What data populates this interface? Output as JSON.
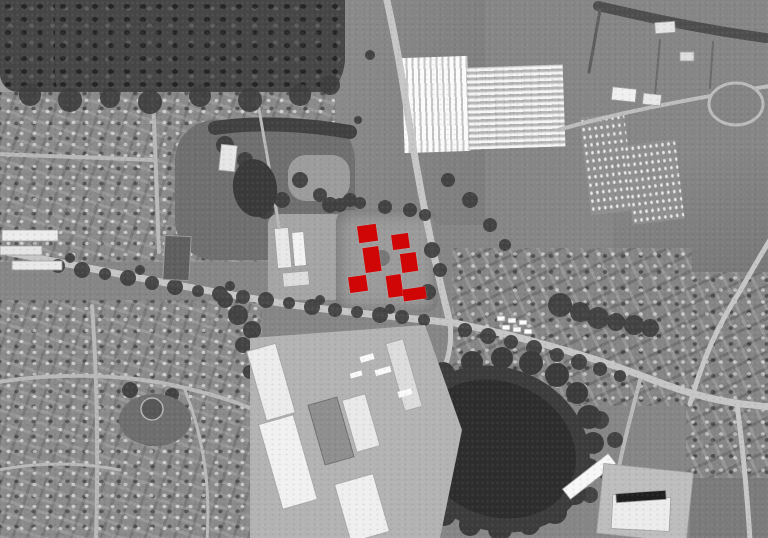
{
  "meta": {
    "title": "Grayscale aerial orthophoto with red-highlighted site buildings",
    "image_type": "annotated satellite / aerial photograph",
    "canvas": {
      "width": 768,
      "height": 538
    }
  },
  "palette": {
    "base_gray": "#868686",
    "forest_dark": "#464646",
    "water_dark": "#2d2d2d",
    "road_light": "#c6c6c6",
    "building_white": "#efefef",
    "highlight_red": "#d00505"
  },
  "annotations": {
    "site_buildings": {
      "color": "#d00505",
      "rotation_deg": -8,
      "markers": [
        {
          "id": "highlighted-building-1",
          "cx": 367,
          "cy": 233,
          "w": 19,
          "h": 17
        },
        {
          "id": "highlighted-building-2",
          "cx": 400,
          "cy": 241,
          "w": 17,
          "h": 15
        },
        {
          "id": "highlighted-building-3",
          "cx": 371.5,
          "cy": 259.5,
          "w": 15.5,
          "h": 25
        },
        {
          "id": "highlighted-building-4",
          "cx": 408.5,
          "cy": 262,
          "w": 15.5,
          "h": 18.5
        },
        {
          "id": "highlighted-building-5",
          "cx": 358,
          "cy": 284,
          "w": 18,
          "h": 15.5
        },
        {
          "id": "highlighted-building-6",
          "cx": 394,
          "cy": 286,
          "w": 15,
          "h": 21.5
        },
        {
          "id": "highlighted-building-7",
          "cx": 414.5,
          "cy": 294,
          "w": 22.5,
          "h": 11.5
        }
      ]
    }
  },
  "regions": {
    "forest_top_left": "Dense woodland (north-west)",
    "field_left_edge": "Small field at left edge",
    "residential_nw": "Residential area north of main road",
    "residential_sw": "Residential area south-west",
    "residential_se": "Housing along road (south-east)",
    "residential_e": "Housing along east edge",
    "park_center": "Park with pond and trees",
    "clearing_center": "Grass clearing",
    "nursery_pad": "Nursery compound",
    "site_pad": "Development site (highlighted buildings)",
    "fields_top_center": "Open fields (north)",
    "greenhouse_west": "Glasshouse complex – west block",
    "greenhouse_east": "Glasshouse complex – east block",
    "orchard_a": "Orchard rows A",
    "orchard_b": "Orchard rows B",
    "field_east": "Large open field (east)",
    "field_bottom_right": "Field (south-east corner)",
    "pond": "Pond ringed by trees",
    "industrial": "Industrial / warehouse estate",
    "trees_south": "Tree belt (south)",
    "linework": "Roads, hedgerows, trees and buildings",
    "highlight_layer": "Red site-building highlights"
  }
}
